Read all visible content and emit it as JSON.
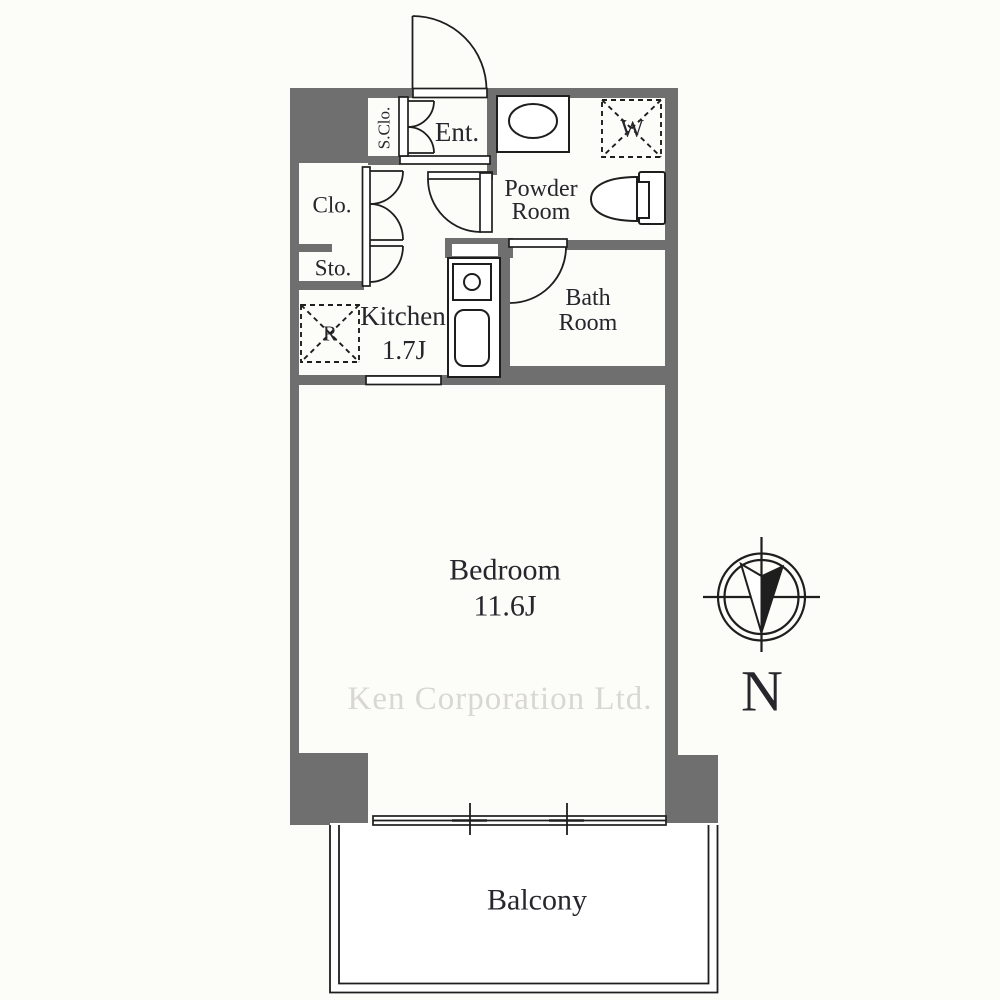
{
  "floorplan": {
    "watermark": {
      "text": "Ken Corporation Ltd."
    },
    "compass": {
      "north_label": "N"
    },
    "rooms": {
      "entrance": {
        "label": "Ent."
      },
      "shoe_closet": {
        "label": "S.Clo."
      },
      "closet": {
        "label": "Clo."
      },
      "storage": {
        "label": "Sto."
      },
      "kitchen": {
        "label": "Kitchen",
        "area": "1.7J"
      },
      "powder_room": {
        "line1": "Powder",
        "line2": "Room"
      },
      "bath_room": {
        "line1": "Bath",
        "line2": "Room"
      },
      "bedroom": {
        "label": "Bedroom",
        "area": "11.6J"
      },
      "balcony": {
        "label": "Balcony"
      }
    },
    "fixtures": {
      "washer_label": "W",
      "refrigerator_label": "R"
    },
    "colors": {
      "wall": "#6f6f6f",
      "line": "#1e1e1e",
      "text": "#26262c",
      "watermark": "#d8d7d3",
      "bg": "#fcfcf9",
      "room": "#ffffff"
    }
  }
}
